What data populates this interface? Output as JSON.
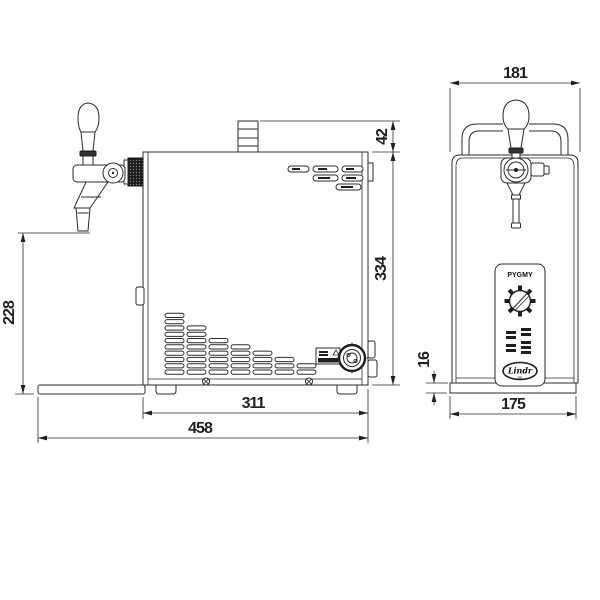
{
  "drawing": {
    "type": "technical dimension drawing",
    "subject": "draft beer dispenser with tap, side and front views",
    "line_color": "#2b2b2b",
    "background": "#ffffff"
  },
  "dims": {
    "spout_to_base_height": "228",
    "handle_above_body": "42",
    "body_height": "334",
    "body_depth": "311",
    "overall_depth_with_tray": "458",
    "overall_width": "181",
    "base_height": "16",
    "base_width": "175"
  },
  "panel": {
    "model_label": "PYGMY",
    "brand_label": "Lindr",
    "brand_sub_label": "cz"
  },
  "vents": {
    "columns": [
      10,
      8,
      6,
      5,
      4,
      3,
      2
    ]
  }
}
